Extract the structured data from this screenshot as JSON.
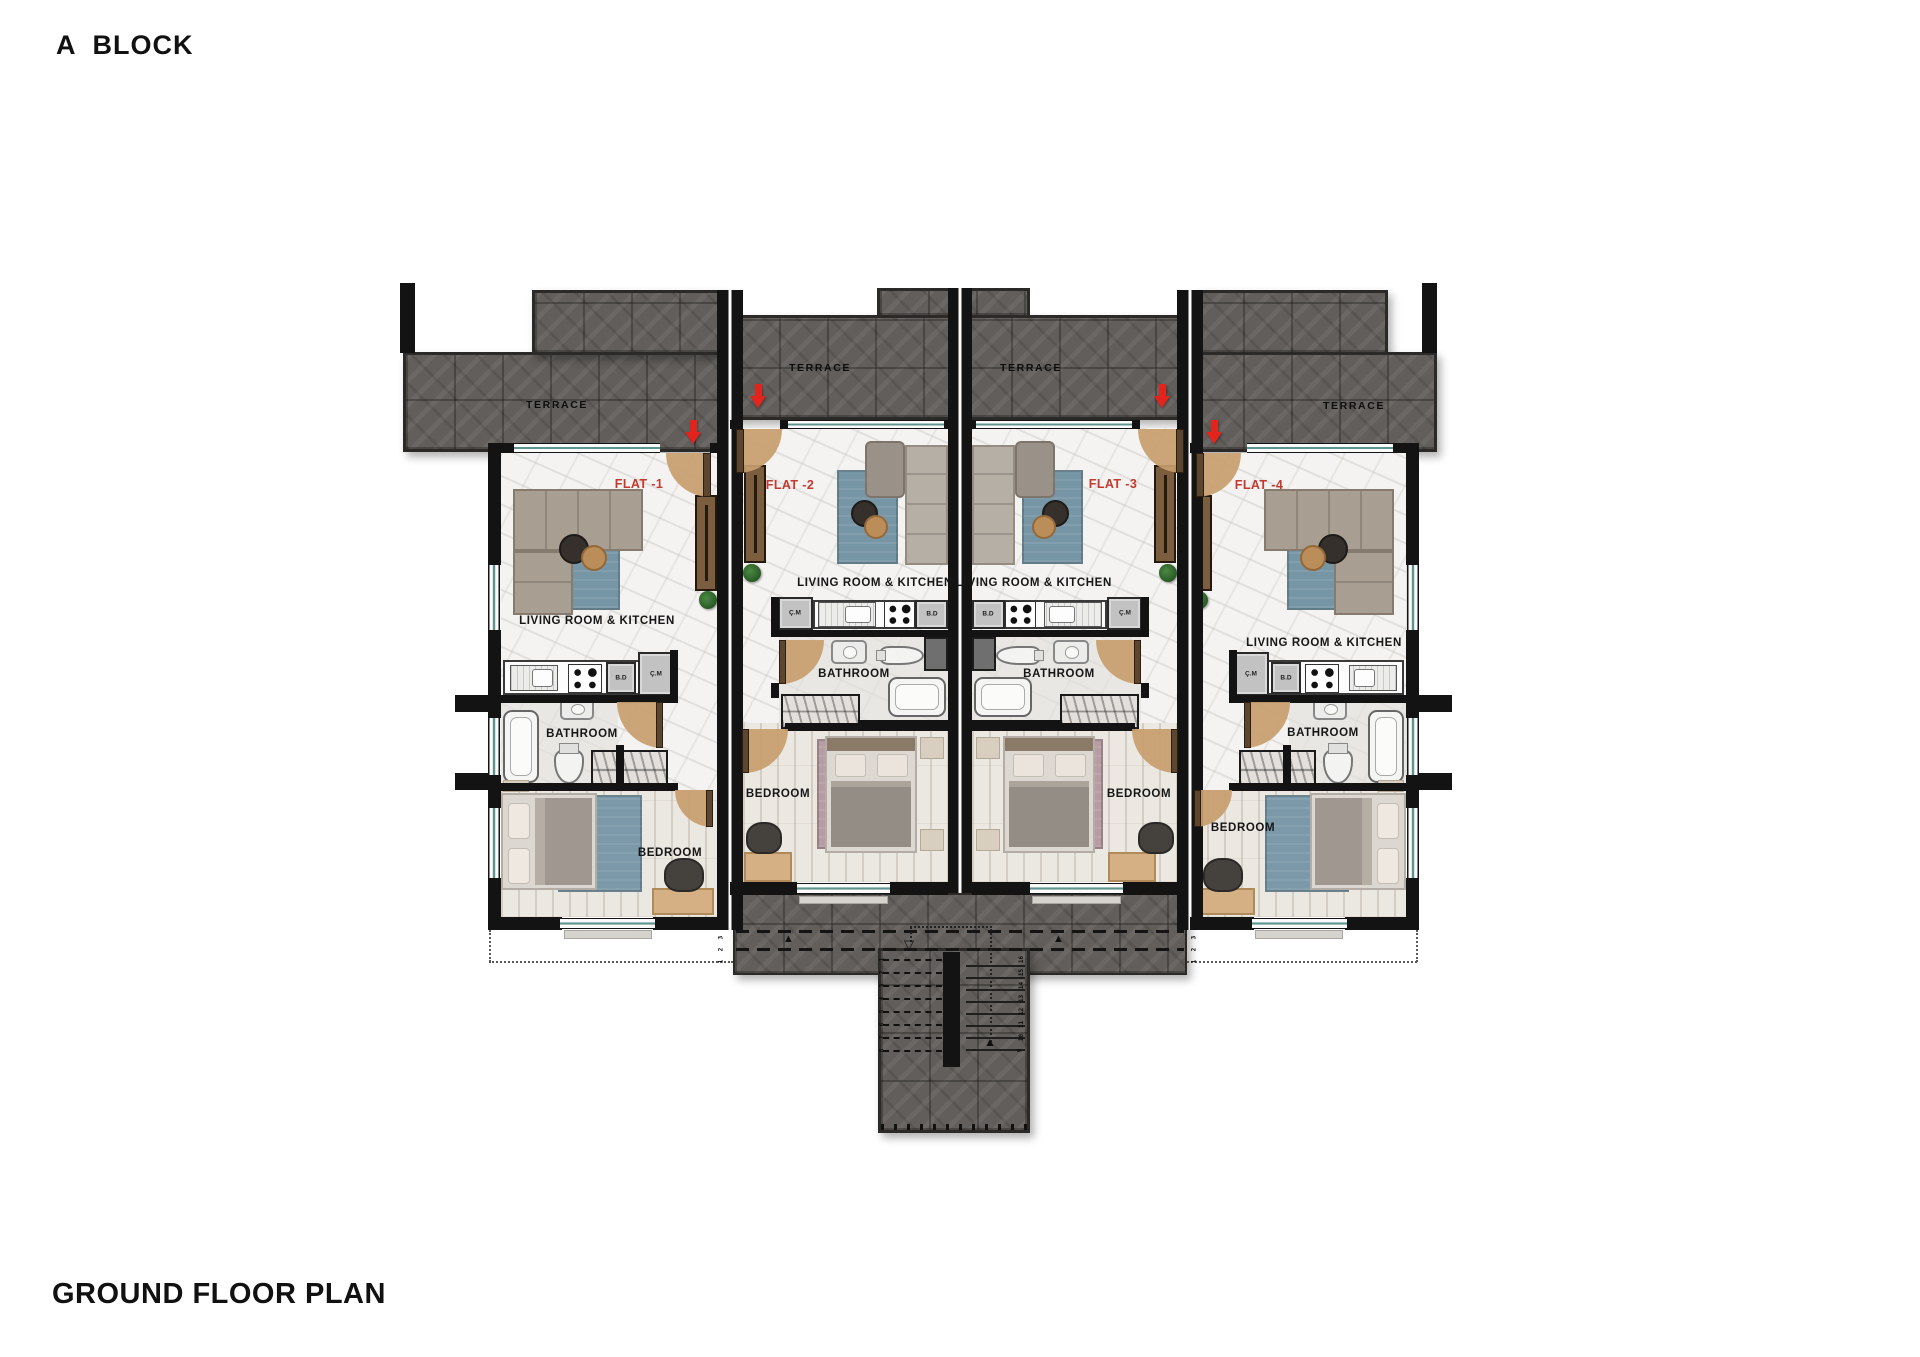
{
  "title": "A  BLOCK",
  "plan_label": "GROUND FLOOR PLAN",
  "flats": [
    {
      "name": "FLAT -1",
      "terrace_label": "TERRACE",
      "living_label": "LIVING ROOM & KITCHEN",
      "bathroom_label": "BATHROOM",
      "bedroom_label": "BEDROOM",
      "bd_label": "B.D",
      "cm_label": "Ç.M"
    },
    {
      "name": "FLAT -2",
      "terrace_label": "TERRACE",
      "living_label": "LIVING ROOM & KITCHEN",
      "bathroom_label": "BATHROOM",
      "bedroom_label": "BEDROOM",
      "bd_label": "B.D",
      "cm_label": "Ç.M"
    },
    {
      "name": "FLAT -3",
      "terrace_label": "TERRACE",
      "living_label": "LIVING ROOM & KITCHEN",
      "bathroom_label": "BATHROOM",
      "bedroom_label": "BEDROOM",
      "bd_label": "B.D",
      "cm_label": "Ç.M"
    },
    {
      "name": "FLAT -4",
      "terrace_label": "TERRACE",
      "living_label": "LIVING ROOM & KITCHEN",
      "bathroom_label": "BATHROOM",
      "bedroom_label": "BEDROOM",
      "bd_label": "B.D",
      "cm_label": "Ç.M"
    }
  ],
  "stairs": {
    "left_numbers": [
      "1",
      "2",
      "3",
      "4",
      "5",
      "6",
      "7",
      "8"
    ],
    "right_numbers": [
      "16",
      "15",
      "14",
      "13",
      "12",
      "11",
      "10",
      "9"
    ],
    "walk_numbers": [
      "3",
      "2",
      "1"
    ]
  },
  "icons": {
    "up_triangle": "▲",
    "down_triangle_open": "▽"
  },
  "colors": {
    "flat_label_red": "#c43a30",
    "terrace_tile": "#615e5b",
    "window_teal": "#5f948e",
    "door_arc_tan": "#c79e6e",
    "arrow_red": "#e2241c"
  }
}
